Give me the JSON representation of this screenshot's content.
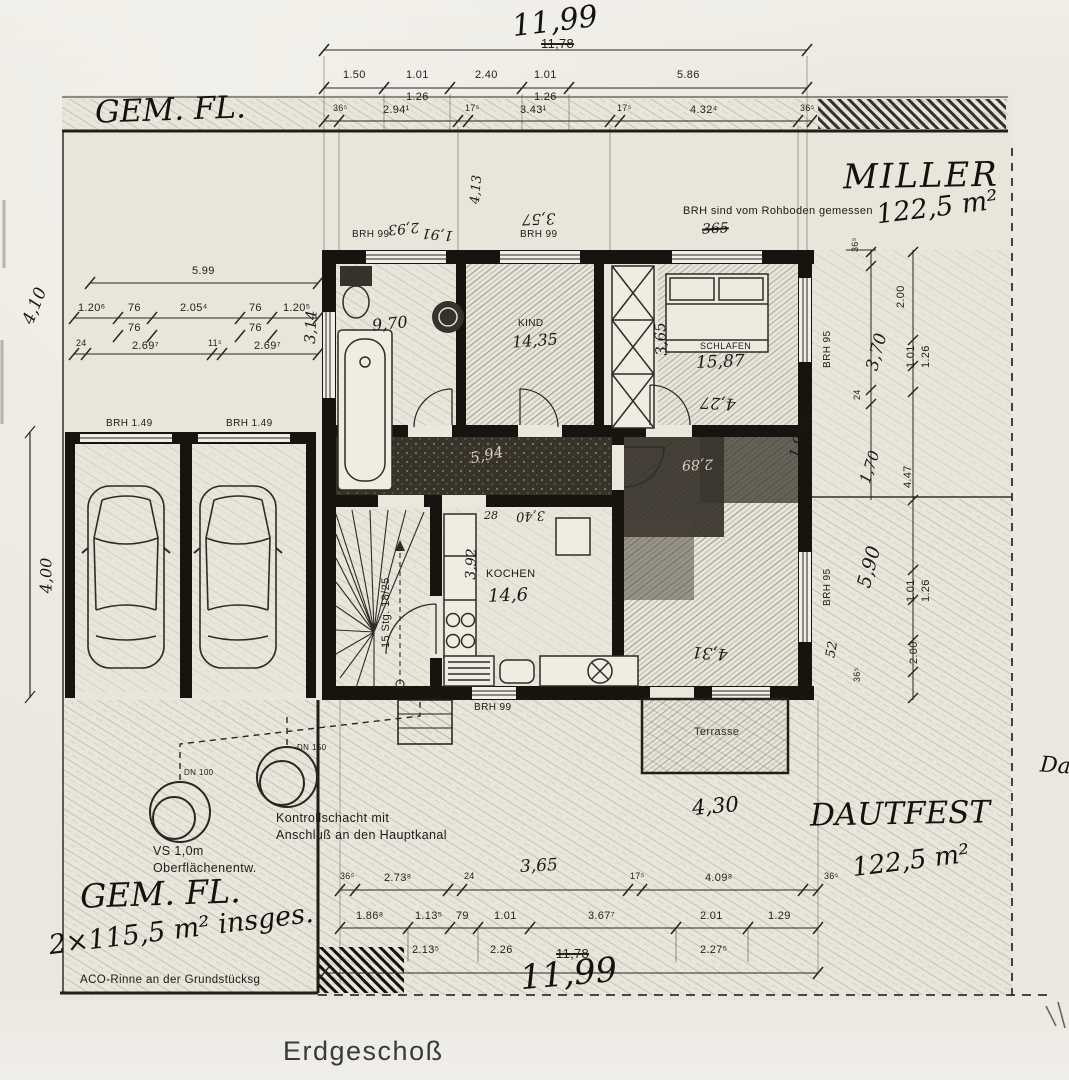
{
  "title": "Erdgeschoß",
  "colors": {
    "paper": "#eae7de",
    "ink": "#1c1a17",
    "pencil": "#4e483f"
  },
  "owners": {
    "top_left_plot": "GEM. FL.",
    "right_name": "MILLER",
    "right_area": "122,5 m²",
    "bottom_name": "DAUTFEST",
    "bottom_area": "122,5 m²",
    "bottom_left_name": "GEM. FL.",
    "bottom_left_area": "2×115,5 m² insges."
  },
  "notes": {
    "brh": "BRH sind vom Rohboden gemessen",
    "kontroll_1": "Kontrollschacht mit",
    "kontroll_2": "Anschluß an den Hauptkanal",
    "vs_1": "VS 1,0m",
    "vs_2": "Oberflächenentw.",
    "aco": "ACO-Rinne an der Grundstücksg",
    "dn100": "DN 100",
    "dn150": "DN 150"
  },
  "rooms": {
    "bad_area": "9,70",
    "kind": "KIND",
    "kind_area": "14,35",
    "schlafen": "SCHLAFEN",
    "schlafen_area": "15,87",
    "kochen": "KOCHEN",
    "kochen_area": "14,6",
    "terrasse": "Terrasse",
    "stairs": "15 Stg. 18/25"
  },
  "brh_labels": [
    "BRH  99",
    "BRH  99",
    "BRH  99",
    "BRH  1.49",
    "BRH  1.49",
    "BRH 95",
    "BRH 95"
  ],
  "hand": {
    "total_top": "11,99",
    "total_bottom": "11,99",
    "d430": "4,30",
    "d365b": "3,65",
    "d370": "3,70",
    "d170": "1,70",
    "d190": "1,90m",
    "d590": "5,90",
    "d410": "4,10",
    "d314": "3,14",
    "d400": "4,00",
    "d413": "4,13",
    "d293": "2,93",
    "d191": "1,91",
    "d357": "3,57",
    "d365x": "365",
    "d365r": "3,65",
    "d427": "4,27",
    "d431": "4,31",
    "d594": "5,94",
    "d289": "2,89",
    "d392": "3,92",
    "d340": "3,40",
    "d28": "28",
    "d52": "52",
    "partial_right": "Dau"
  },
  "printed": {
    "struck_top": "11,78",
    "struck_bottom": "11,78"
  },
  "dims": {
    "top1": [
      "1.50",
      "1.01",
      "1.26",
      "2.40",
      "1.01",
      "1.26",
      "5.86"
    ],
    "top2": [
      "36⁵",
      "2.94¹",
      "17⁵",
      "3.43¹",
      "17⁵",
      "4.32⁴",
      "36⁵"
    ],
    "left0": "5.99",
    "left1": [
      "1.20⁶",
      "76",
      "2.05⁴",
      "76",
      "1.20⁵"
    ],
    "left1b": [
      "76",
      "76"
    ],
    "left2": [
      "24",
      "2.69⁷",
      "11⁵",
      "2.69⁷"
    ],
    "right1": [
      "36⁵",
      "2.00",
      "1.01",
      "1.26",
      "24",
      "4.47",
      "1.01",
      "1.26",
      "2.00",
      "36⁵"
    ],
    "bottom1": [
      "36⁵",
      "2.73⁸",
      "24",
      "17⁵",
      "4.09⁸",
      "36⁵"
    ],
    "bottom2": [
      "1.86⁸",
      "1.13⁵",
      "79",
      "1.01",
      "3.67⁷",
      "2.01",
      "1.29"
    ],
    "bottom2b": [
      "2.13⁵",
      "2.26",
      "2.27⁵"
    ]
  }
}
